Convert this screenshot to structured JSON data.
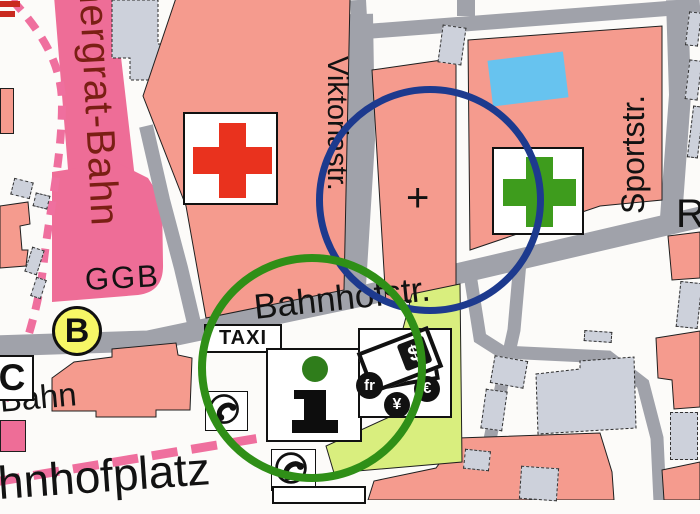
{
  "map": {
    "streets": {
      "gornergrat_bahn": "nergrat-Bahn",
      "viktoriastrasse": "Viktoriastr.",
      "sportstrasse": "Sportstr.",
      "bahnhofstrasse": "Bahnhofstr.",
      "bahnhofplatz": "Bahnhofplatz",
      "bahn": "Bahn",
      "street_r_partial": "R"
    },
    "labels": {
      "ggb": "GGB",
      "church_cross": "+"
    },
    "stops": {
      "bus_stop": "B",
      "stop_c": "C"
    },
    "poi": {
      "taxi": "TAXI"
    },
    "currency": {
      "dollar": "$",
      "franc": "fr",
      "yen": "¥",
      "euro": "€"
    },
    "colors": {
      "building_residential": "#f59b8e",
      "building_public": "#cdd1db",
      "railway_pink": "#ee6d97",
      "road_gray": "#a0a2aa",
      "circle_blue": "#1d3a8e",
      "circle_green": "#2f8f17",
      "highlight_lime": "#d9ee7e",
      "pool_blue": "#67c3ef",
      "cross_red": "#e9321e",
      "cross_green": "#3e9c1d",
      "bus_stop_yellow": "#f7f766"
    }
  }
}
